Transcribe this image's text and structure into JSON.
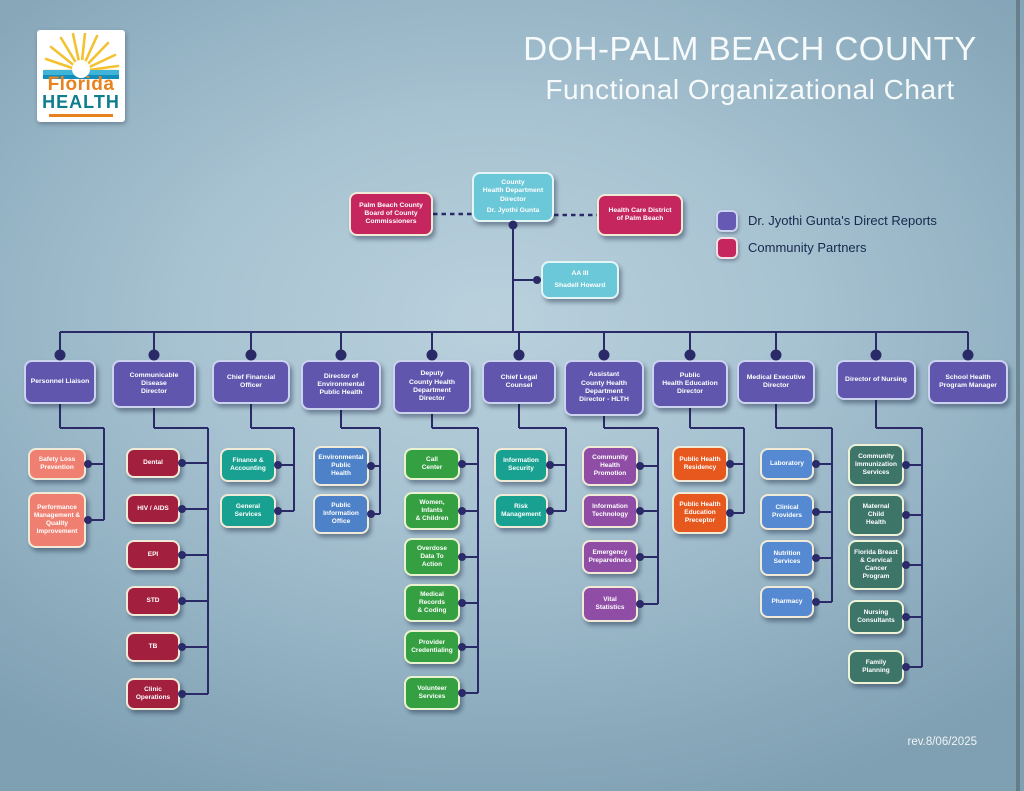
{
  "header": {
    "title_line1": "DOH-PALM BEACH COUNTY",
    "title_line2": "Functional Organizational Chart"
  },
  "logo": {
    "word1": "Florida",
    "word2": "HEALTH"
  },
  "legend": {
    "items": [
      {
        "label": "Dr. Jyothi Gunta's Direct Reports",
        "color": "#6659b4",
        "border": "#ccd3ee"
      },
      {
        "label": "Community Partners",
        "color": "#c5265e",
        "border": "#f0dfe3"
      }
    ]
  },
  "revision": "rev.8/06/2025",
  "palette": {
    "purple": {
      "bg": "#6156ae",
      "border": "#ccd3ee"
    },
    "cyan": {
      "bg": "#6bc8d8",
      "border": "#e4f5f6"
    },
    "partner": {
      "bg": "#c5265e",
      "border": "#f1ead6"
    },
    "maroon": {
      "bg": "#a31f3e",
      "border": "#f1ead6"
    },
    "salmon": {
      "bg": "#ef8071",
      "border": "#f1ead6"
    },
    "teal": {
      "bg": "#18a191",
      "border": "#f1ead6"
    },
    "blue": {
      "bg": "#4e82c8",
      "border": "#f1ead6"
    },
    "blue2": {
      "bg": "#5589d1",
      "border": "#f1ead6"
    },
    "green": {
      "bg": "#35a041",
      "border": "#eaf3cf"
    },
    "violet": {
      "bg": "#8f4da6",
      "border": "#f1ead6"
    },
    "orange": {
      "bg": "#e7581f",
      "border": "#f1ead6"
    },
    "sage": {
      "bg": "#3d7569",
      "border": "#eef3d8"
    }
  },
  "org": {
    "line_color": "#2b2a68",
    "main_y": 332,
    "elbow_y": 428,
    "director": {
      "label": "County\nHealth Department\nDirector",
      "name": "Dr. Jyothi Gunta",
      "x": 472,
      "y": 172,
      "w": 82,
      "h": 50,
      "color": "cyan"
    },
    "aide": {
      "label": "AA III",
      "name": "Shadell Howard",
      "x": 541,
      "y": 261,
      "w": 78,
      "h": 38,
      "color": "cyan"
    },
    "partners": [
      {
        "label": "Palm Beach County\nBoard of County\nCommissioners",
        "x": 349,
        "y": 192,
        "w": 84,
        "h": 44,
        "color": "partner"
      },
      {
        "label": "Health Care District\nof Palm Beach",
        "x": 597,
        "y": 194,
        "w": 86,
        "h": 42,
        "color": "partner"
      }
    ],
    "columns": [
      {
        "label": "Personnel Liaison",
        "x": 24,
        "w": 72,
        "h": 44,
        "cx": 60,
        "trunk": 104,
        "child_x": 28,
        "child_w": 58,
        "child_color": "salmon",
        "children": [
          {
            "label": "Safety Loss\nPrevention",
            "y": 448,
            "h": 32
          },
          {
            "label": "Performance\nManagement &\nQuality\nImprovement",
            "y": 492,
            "h": 56
          }
        ]
      },
      {
        "label": "Communicable\nDisease\nDirector",
        "x": 112,
        "w": 84,
        "h": 48,
        "cx": 154,
        "trunk": 208,
        "child_x": 126,
        "child_w": 54,
        "child_color": "maroon",
        "children": [
          {
            "label": "Dental",
            "y": 448,
            "h": 30
          },
          {
            "label": "HIV / AIDS",
            "y": 494,
            "h": 30
          },
          {
            "label": "EPI",
            "y": 540,
            "h": 30
          },
          {
            "label": "STD",
            "y": 586,
            "h": 30
          },
          {
            "label": "TB",
            "y": 632,
            "h": 30
          },
          {
            "label": "Clinic\nOperations",
            "y": 678,
            "h": 32
          }
        ]
      },
      {
        "label": "Chief Financial\nOfficer",
        "x": 212,
        "w": 78,
        "h": 44,
        "cx": 251,
        "trunk": 294,
        "child_x": 220,
        "child_w": 56,
        "child_color": "teal",
        "children": [
          {
            "label": "Finance &\nAccounting",
            "y": 448,
            "h": 34
          },
          {
            "label": "General\nServices",
            "y": 494,
            "h": 34
          }
        ]
      },
      {
        "label": "Director of\nEnvironmental\nPublic Health",
        "x": 301,
        "w": 80,
        "h": 50,
        "cx": 341,
        "trunk": 380,
        "child_x": 313,
        "child_w": 56,
        "child_color": "blue",
        "children": [
          {
            "label": "Environmental\nPublic\nHealth",
            "y": 446,
            "h": 40
          },
          {
            "label": "Public\nInformation\nOffice",
            "y": 494,
            "h": 40
          }
        ]
      },
      {
        "label": "Deputy\nCounty Health\nDepartment\nDirector",
        "x": 393,
        "w": 78,
        "h": 54,
        "cx": 432,
        "trunk": 478,
        "child_x": 404,
        "child_w": 56,
        "child_color": "green",
        "children": [
          {
            "label": "Call\nCenter",
            "y": 448,
            "h": 32
          },
          {
            "label": "Women,\nInfants\n& Children",
            "y": 492,
            "h": 38
          },
          {
            "label": "Overdose\nData To\nAction",
            "y": 538,
            "h": 38
          },
          {
            "label": "Medical\nRecords\n& Coding",
            "y": 584,
            "h": 38
          },
          {
            "label": "Provider\nCredentialing",
            "y": 630,
            "h": 34
          },
          {
            "label": "Volunteer\nServices",
            "y": 676,
            "h": 34
          }
        ]
      },
      {
        "label": "Chief Legal\nCounsel",
        "x": 482,
        "w": 74,
        "h": 44,
        "cx": 519,
        "trunk": 566,
        "child_x": 494,
        "child_w": 54,
        "child_color": "teal",
        "children": [
          {
            "label": "Information\nSecurity",
            "y": 448,
            "h": 34
          },
          {
            "label": "Risk\nManagement",
            "y": 494,
            "h": 34
          }
        ]
      },
      {
        "label": "Assistant\nCounty Health\nDepartment\nDirector - HLTH",
        "x": 564,
        "w": 80,
        "h": 56,
        "cx": 604,
        "trunk": 658,
        "child_x": 582,
        "child_w": 56,
        "child_color": "violet",
        "children": [
          {
            "label": "Community\nHealth\nPromotion",
            "y": 446,
            "h": 40
          },
          {
            "label": "Information\nTechnology",
            "y": 494,
            "h": 34
          },
          {
            "label": "Emergency\nPreparedness",
            "y": 540,
            "h": 34
          },
          {
            "label": "Vital\nStatistics",
            "y": 586,
            "h": 36
          }
        ]
      },
      {
        "label": "Public\nHealth Education\nDirector",
        "x": 652,
        "w": 76,
        "h": 48,
        "cx": 690,
        "trunk": 744,
        "child_x": 672,
        "child_w": 56,
        "child_color": "orange",
        "children": [
          {
            "label": "Public Health\nResidency",
            "y": 446,
            "h": 36
          },
          {
            "label": "Public Health\nEducation\nPreceptor",
            "y": 492,
            "h": 42
          }
        ]
      },
      {
        "label": "Medical Executive\nDirector",
        "x": 737,
        "w": 78,
        "h": 44,
        "cx": 776,
        "trunk": 832,
        "child_x": 760,
        "child_w": 54,
        "child_color": "blue2",
        "children": [
          {
            "label": "Laboratory",
            "y": 448,
            "h": 32
          },
          {
            "label": "Clinical\nProviders",
            "y": 494,
            "h": 36
          },
          {
            "label": "Nutrition\nServices",
            "y": 540,
            "h": 36
          },
          {
            "label": "Pharmacy",
            "y": 586,
            "h": 32
          }
        ]
      },
      {
        "label": "Director of Nursing",
        "x": 836,
        "w": 80,
        "h": 40,
        "cx": 876,
        "trunk": 922,
        "child_x": 848,
        "child_w": 56,
        "child_color": "sage",
        "children": [
          {
            "label": "Community\nImmunization\nServices",
            "y": 444,
            "h": 42
          },
          {
            "label": "Maternal\nChild\nHealth",
            "y": 494,
            "h": 42
          },
          {
            "label": "Florida Breast\n& Cervical\nCancer\nProgram",
            "y": 540,
            "h": 50
          },
          {
            "label": "Nursing\nConsultants",
            "y": 600,
            "h": 34
          },
          {
            "label": "Family\nPlanning",
            "y": 650,
            "h": 34
          }
        ]
      },
      {
        "label": "School Health\nProgram Manager",
        "x": 928,
        "w": 80,
        "h": 44,
        "cx": 968,
        "trunk": null,
        "child_x": 0,
        "child_w": 0,
        "child_color": "purple",
        "children": []
      }
    ]
  }
}
